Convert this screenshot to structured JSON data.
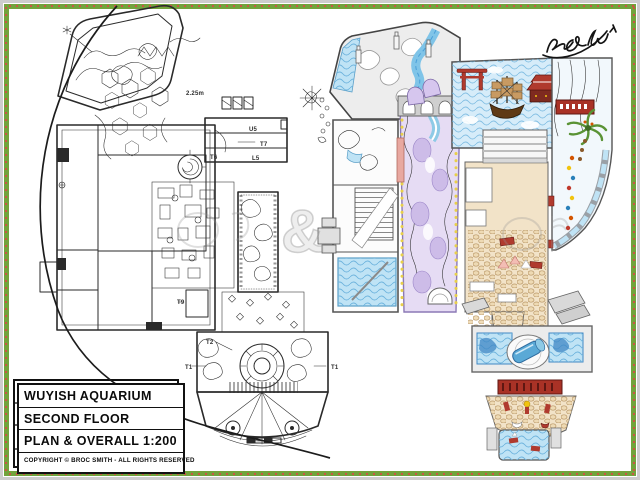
{
  "title_block": {
    "project": "WUYISH AQUARIUM",
    "sheet": "SECOND FLOOR",
    "scale_line": "PLAN & OVERALL 1:200",
    "copyright": "COPYRIGHT © BROC SMITH - ALL RIGHTS RESERVED"
  },
  "signature": {
    "text": "Broc Smith"
  },
  "watermark": {
    "symbol": "&"
  },
  "plan_labels": [
    {
      "text": "2.25m",
      "x": 183,
      "y": 88
    },
    {
      "text": "U5",
      "x": 246,
      "y": 124
    },
    {
      "text": "T7",
      "x": 257,
      "y": 139
    },
    {
      "text": "T6",
      "x": 207,
      "y": 152
    },
    {
      "text": "L5",
      "x": 249,
      "y": 153
    },
    {
      "text": "T9",
      "x": 174,
      "y": 297
    },
    {
      "text": "T2",
      "x": 203,
      "y": 337
    },
    {
      "text": "T1",
      "x": 182,
      "y": 362
    },
    {
      "text": "T1",
      "x": 328,
      "y": 362
    }
  ],
  "colors": {
    "ink": "#2a2a2a",
    "green": "#72a33c",
    "dot": "#cc5544",
    "water": "#bfe3f5",
    "waterline": "#6db3dd",
    "deep": "#5aa9d6",
    "lav": "#e6dcf4",
    "lavline": "#8b79b5",
    "tan": "#f2e3c8",
    "cobble": "#b3905e",
    "red": "#b03a2e",
    "darkred": "#5e1712",
    "brown": "#5f3a16",
    "sail": "#c89a62",
    "palm": "#5a9335",
    "yellow": "#e8cf4a",
    "wall": "#9a9a9a",
    "ltgray": "#ececec"
  }
}
